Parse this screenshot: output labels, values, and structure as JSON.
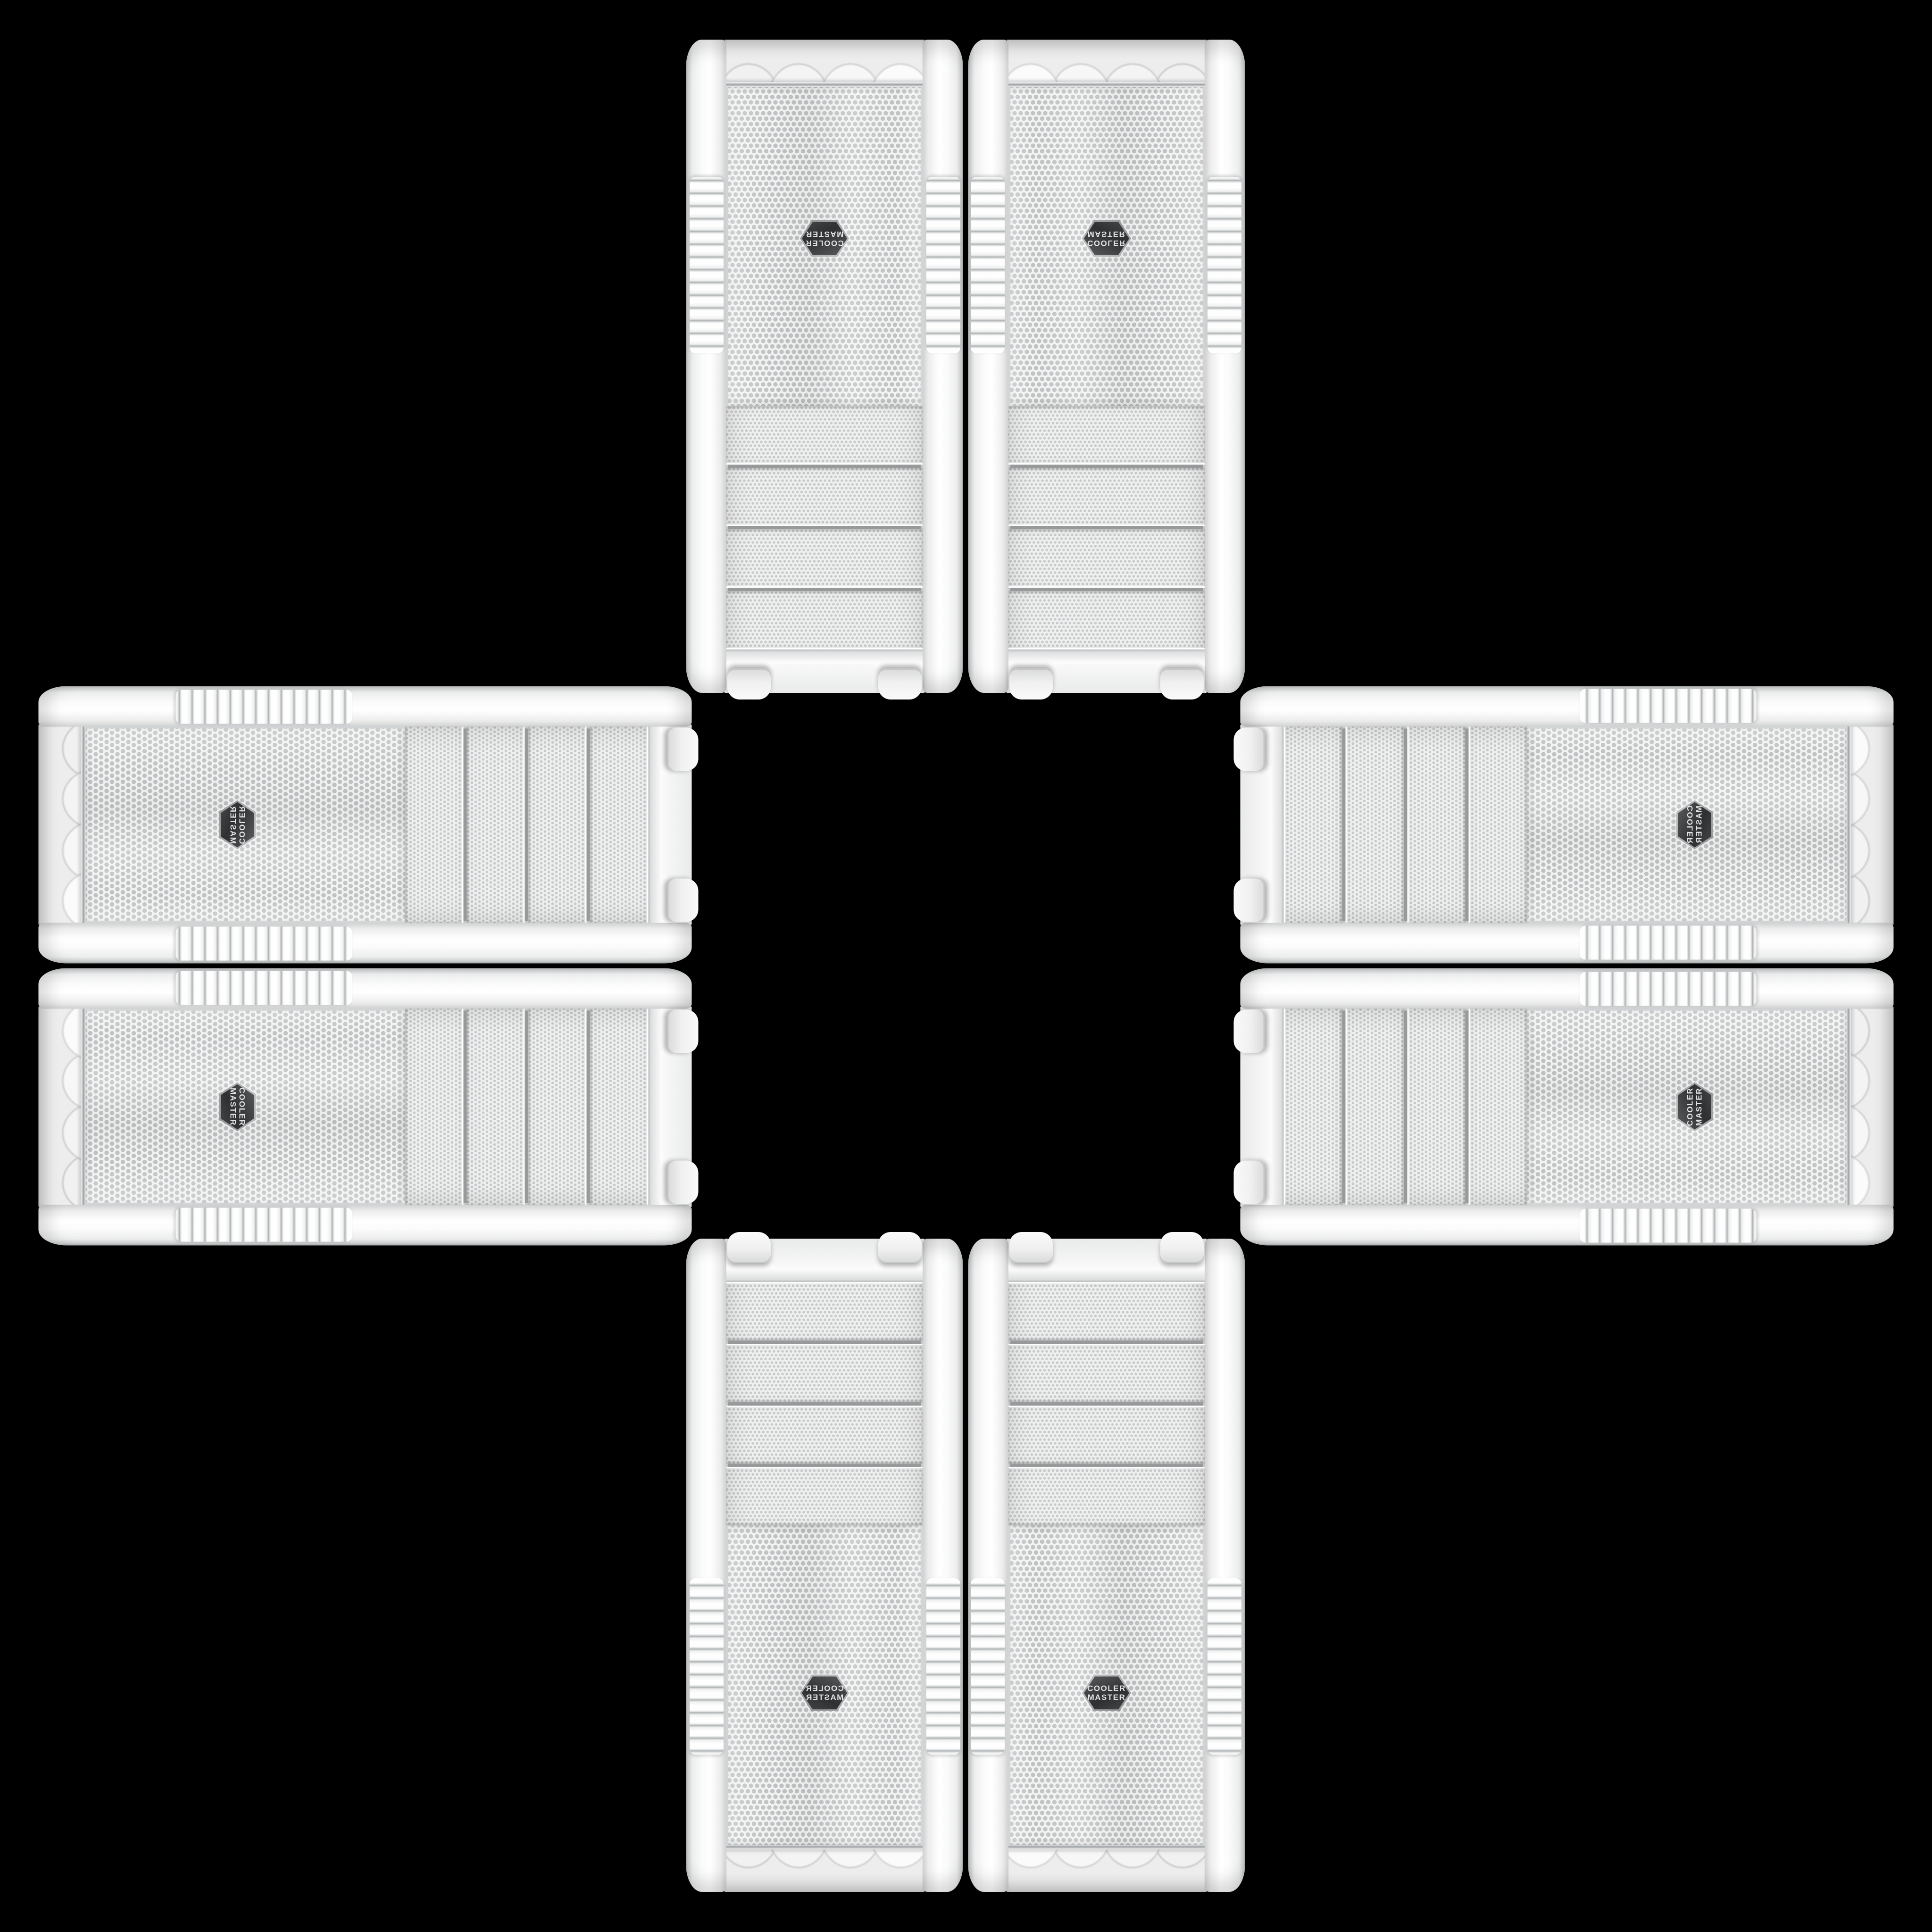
{
  "scene": {
    "type": "product-collage",
    "background_color": "#000000",
    "description": "Eight identical white Cooler Master mid-tower PC cases shown front-panel-on, arranged as mirrored pairs forming a plus / cross pattern around an empty black center; the drive-bay ends point toward the center and the logo ends point outward",
    "case_count": 8
  },
  "brand": {
    "logo_line1": "COOLER",
    "logo_line2": "MASTER",
    "badge_shape": "hexagon",
    "badge_color": "#333435",
    "badge_rim_color": "#aaacad",
    "badge_text_color": "#e4e5e6"
  },
  "case_style": {
    "body_color": "#f4f4f4",
    "mesh_dot_color": "#bfc1c2",
    "chrome_trim_color": "#9ea1a3",
    "drive_bay_count": 4
  },
  "cases": [
    {
      "id": "top-left",
      "orientation": "rotated-180"
    },
    {
      "id": "top-right",
      "orientation": "flipped-vertical"
    },
    {
      "id": "left-top",
      "orientation": "rotated-90-mirrored"
    },
    {
      "id": "left-bottom",
      "orientation": "rotated-90"
    },
    {
      "id": "right-top",
      "orientation": "rotated-270-mirrored"
    },
    {
      "id": "right-bottom",
      "orientation": "rotated-270"
    },
    {
      "id": "bottom-left",
      "orientation": "flipped-horizontal"
    },
    {
      "id": "bottom-right",
      "orientation": "upright"
    }
  ]
}
